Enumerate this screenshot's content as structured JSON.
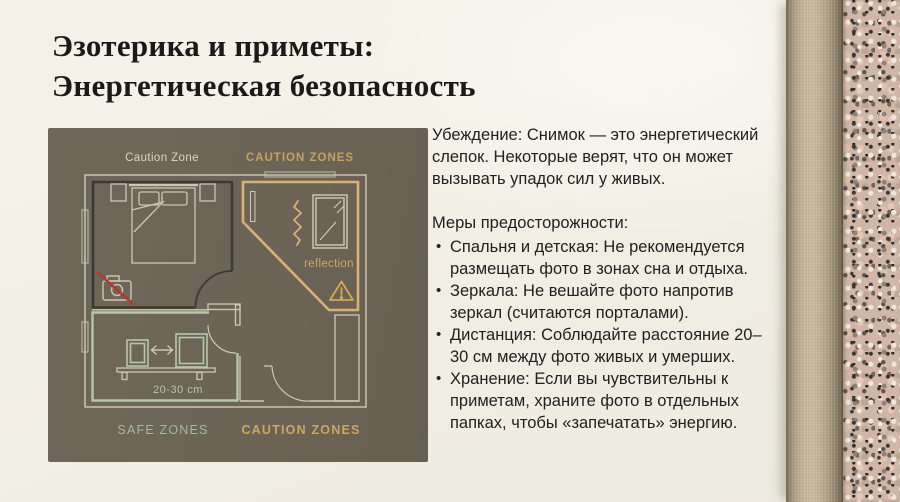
{
  "slide": {
    "title": [
      "Эзотерика и приметы:",
      "Энергетическая безопасность"
    ]
  },
  "diagram": {
    "labels": {
      "zone_top_left": "Caution Zone",
      "zone_top_right": "CAUTION ZONES",
      "zone_bottom_left": "SAFE ZONES",
      "zone_bottom_right": "CAUTION ZONES",
      "mirror": "reflection",
      "distance": "20-30 cm"
    },
    "palette": {
      "panel_background": "#6c6456",
      "caution_gold": "#d8b273",
      "safe_sage": "#b9c6a9",
      "wall_light": "#d2c9b5",
      "wall_dark": "#3b3a34",
      "alert_red": "#b43a31"
    }
  },
  "content": {
    "intro": "Убеждение: Снимок — это энергетический слепок. Некоторые верят, что он может вызывать упадок сил у живых.",
    "precautions_title": "Меры предосторожности:",
    "precautions": [
      "Спальня и детская: Не рекомендуется размещать фото в зонах сна и отдыха.",
      "Зеркала: Не вешайте фото напротив зеркал (считаются порталами).",
      "Дистанция: Соблюдайте расстояние 20–30 см между фото живых и умерших.",
      "Хранение: Если вы чувствительны к приметам, храните фото в отдельных папках, чтобы «запечатать» энергию."
    ]
  },
  "background": {
    "base": "#f2efe5"
  }
}
